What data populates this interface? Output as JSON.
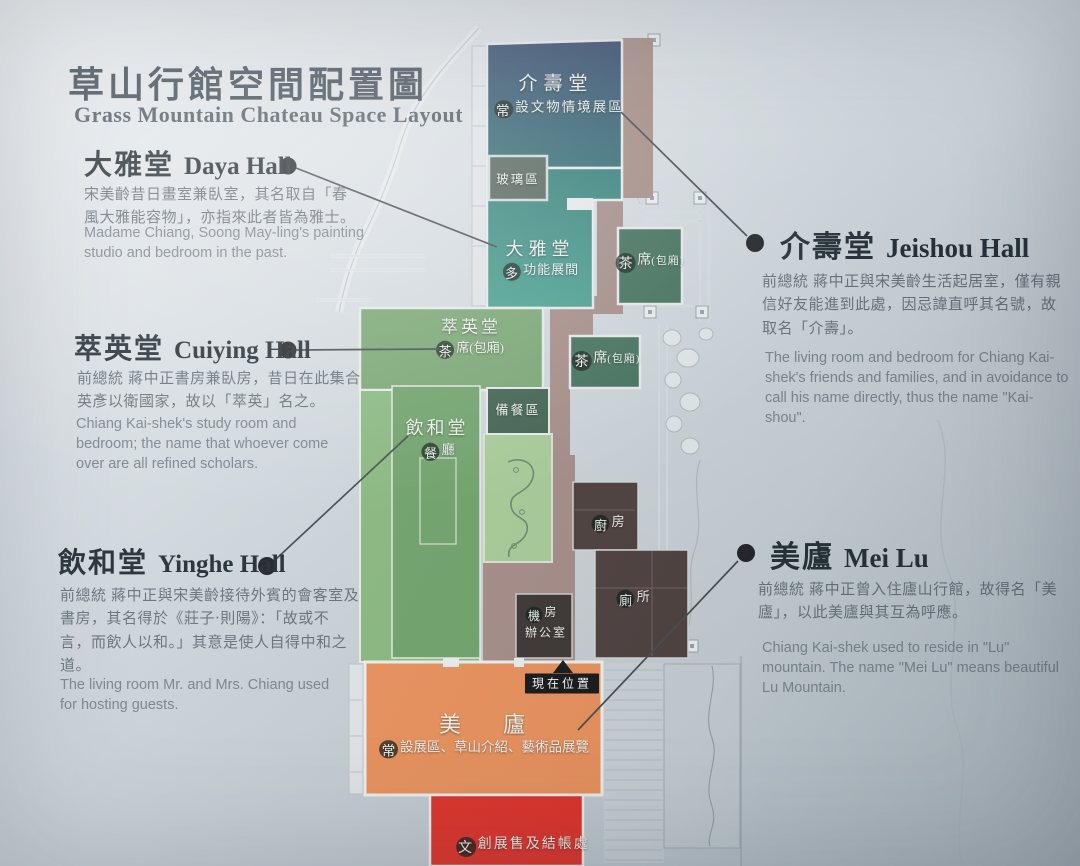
{
  "title": {
    "zh": "草山行館空間配置圖",
    "en": "Grass Mountain Chateau Space Layout"
  },
  "sections": {
    "daya": {
      "zh": "大雅堂",
      "name": "Daya Hall",
      "body_zh": "宋美齡昔日畫室兼臥室，其名取自「春風大雅能容物」，亦指來此者皆為雅士。",
      "body_en": "Madame Chiang, Soong May-ling's painting studio and bedroom in the past."
    },
    "cuiying": {
      "zh": "萃英堂",
      "name": "Cuiying Hall",
      "body_zh": "前總統 蔣中正書房兼臥房，昔日在此集合英彥以衛國家，故以「萃英」名之。",
      "body_en": "Chiang Kai-shek's study room and bedroom; the name that whoever come over are all refined scholars."
    },
    "yinghe": {
      "zh": "飲和堂",
      "name": "Yinghe Hall",
      "body_zh": "前總統 蔣中正與宋美齡接待外賓的會客室及書房，其名得於《莊子‧則陽》：「故或不言，而飲人以和。」其意是使人自得中和之道。",
      "body_en": "The living room Mr. and Mrs. Chiang used for hosting guests."
    },
    "jeishou": {
      "zh": "介壽堂",
      "name": "Jeishou Hall",
      "body_zh": "前總統 蔣中正與宋美齡生活起居室，僅有親信好友能進到此處，因忌諱直呼其名號，故取名「介壽」。",
      "body_en": "The living room and bedroom for Chiang Kai-shek's friends and families, and in avoidance to call his name directly, thus the name \"Kai-shou\"."
    },
    "meilu": {
      "zh": "美廬",
      "name": "Mei Lu",
      "body_zh": "前總統 蔣中正曾入住廬山行館，故得名「美廬」，以此美廬與其互為呼應。",
      "body_en": "Chiang Kai-shek used to reside in \"Lu\" mountain. The name \"Mei Lu\" means beautiful Lu Mountain."
    }
  },
  "map": {
    "jieshou": {
      "label": "介壽堂",
      "sub": "常設文物情境展區"
    },
    "glass": {
      "label": "玻璃區"
    },
    "daya": {
      "label": "大雅堂",
      "sub": "多功能展間"
    },
    "tea1": {
      "label": "茶席",
      "sub": "(包廂)"
    },
    "tea2": {
      "label": "茶席",
      "sub": "(包廂)"
    },
    "cuiying": {
      "label": "萃英堂",
      "sub": "茶席(包廂)"
    },
    "prep": {
      "label": "備餐區"
    },
    "yinghe": {
      "label": "飲和堂",
      "sub": "餐廳"
    },
    "kitchen": {
      "label": "廚房"
    },
    "toilet": {
      "label": "廁所"
    },
    "office": {
      "line1": "機房",
      "line2": "辦公室"
    },
    "here": {
      "label": "現在位置"
    },
    "meilu": {
      "label": "美　廬",
      "sub": "常設展區、草山介紹、藝術品展覽"
    },
    "shop": {
      "label": "文創展售及結帳處"
    }
  },
  "colors": {
    "hall_navy": "#35496d",
    "navy_bottom": "#2e6b72",
    "teal_top": "#2f7d78",
    "teal_bottom": "#46a28f",
    "glass_panel": "#53625a",
    "tea_green": "#3e6e57",
    "prep_green": "#3c5f4b",
    "cuiying_green": "#79a871",
    "yinghe_outer_green": "#8abc7e",
    "yinghe_green": "#6fa468",
    "garden_green": "#abd098",
    "corridor": "#a88d86",
    "dark_room": "#4a3b38",
    "office_dark": "#38312d",
    "meilu_orange": "#f09157",
    "shop_red": "#e52b20",
    "tag_black": "#111111"
  }
}
